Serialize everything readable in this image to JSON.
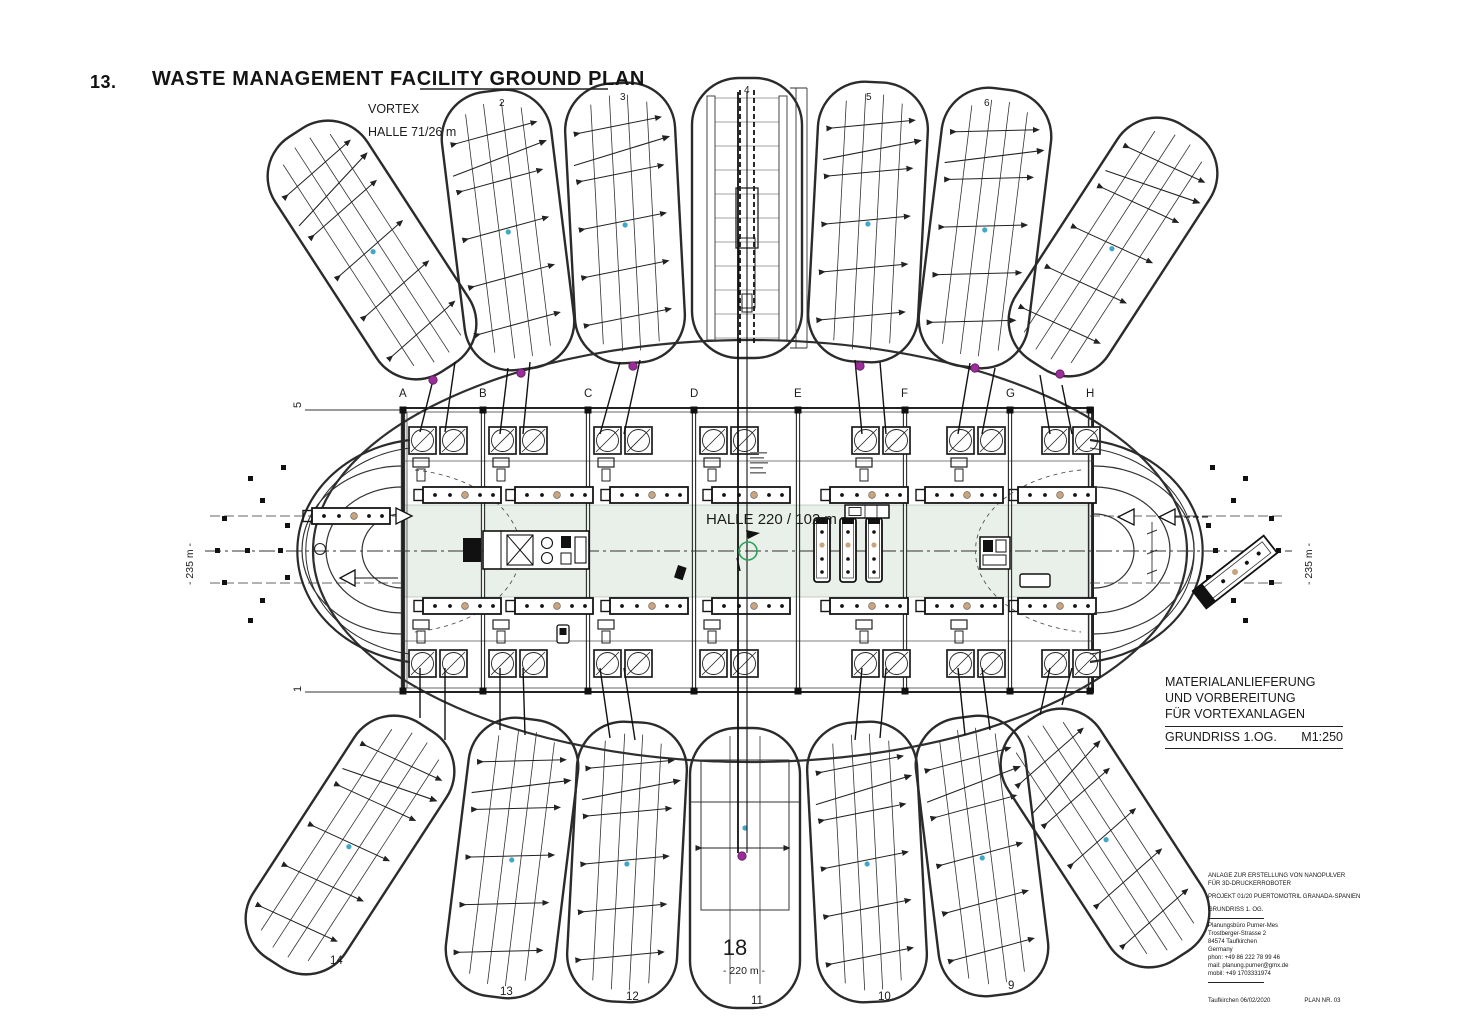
{
  "page": {
    "number": "13.",
    "title": "WASTE MANAGEMENT FACILITY GROUND PLAN"
  },
  "plan": {
    "vortex_label": {
      "line1": "VORTEX",
      "line2": "HALLE 71/26 m"
    },
    "central_hall_label": "HALLE 220 / 102 m",
    "grid_letters": [
      "A",
      "B",
      "C",
      "D",
      "E",
      "F",
      "G",
      "H"
    ],
    "row_top": "5",
    "row_bottom": "1",
    "dim_left": "- 235 m -",
    "dim_right": "- 235 m -",
    "dim_bottom": "- 220 m -",
    "center_mark": "18",
    "hall_numbers_top": [
      "2",
      "3",
      "4",
      "5",
      "6"
    ],
    "hall_numbers_bottom": [
      "14",
      "13",
      "12",
      "11",
      "10",
      "9"
    ],
    "colors": {
      "purple": "#9b2d9b",
      "blue": "#3fa8c9",
      "green": "#2ea25a",
      "aisle": "#e9efe9"
    }
  },
  "titleblock": {
    "line1": "MATERIALANLIEFERUNG",
    "line2": "UND VORBEREITUNG",
    "line3": "FÜR VORTEXANLAGEN",
    "drawing": "GRUNDRISS  1.OG.",
    "scale": "M1:250"
  },
  "infoblock": {
    "l1": "ANLAGE ZUR ERSTELLUNG VON NANOPULVER",
    "l2": "FÜR 3D-DRUCKERROBOTER",
    "l3": "PROJEKT 01/20 PUERTOMOTRIL GRANADA-SPANIEN",
    "l4": "GRUNDRISS  1. OG.",
    "firm1": "Planungsbüro Purner-Mes",
    "firm2": "Trostberger-Strasse 2",
    "firm3": "84574 Taufkirchen",
    "firm4": "Germany",
    "firm5": "phon: +49 86 222 78 99 46",
    "firm6": "mail: planung.purner@gmx.de",
    "firm7": "mobil: +49 1703331974",
    "footer_left": "Taufkirchen  06/02/2020",
    "footer_right": "PLAN  NR. 03"
  }
}
